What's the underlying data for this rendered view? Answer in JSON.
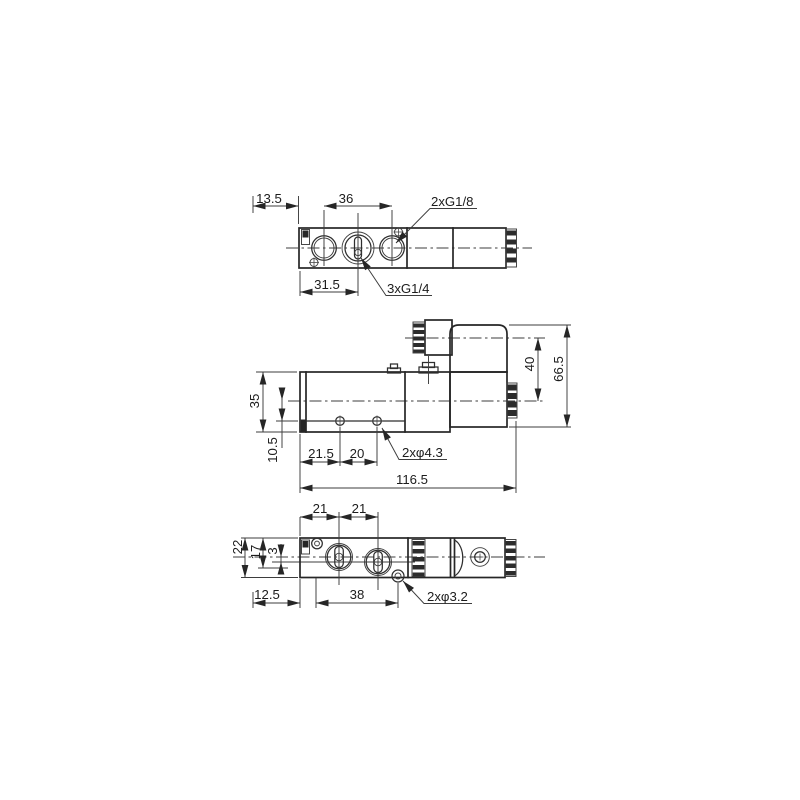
{
  "page": {
    "background": "#ffffff",
    "line_color": "#262626"
  },
  "views": {
    "top": {
      "dims": {
        "d13_5": "13.5",
        "d36": "36",
        "d31_5": "31.5"
      },
      "labels": {
        "g18": "2xG1/8",
        "g14": "3xG1/4"
      }
    },
    "side": {
      "dims": {
        "d35": "35",
        "d10_5": "10.5",
        "d21_5": "21.5",
        "d20": "20",
        "d116_5": "116.5",
        "d40": "40",
        "d66_5": "66.5"
      },
      "labels": {
        "holes": "2xφ4.3"
      }
    },
    "bottom": {
      "dims": {
        "d21a": "21",
        "d21b": "21",
        "d22": "22",
        "d17": "17",
        "d3": "3",
        "d12_5": "12.5",
        "d38": "38"
      },
      "labels": {
        "holes": "2xφ3.2"
      }
    }
  }
}
